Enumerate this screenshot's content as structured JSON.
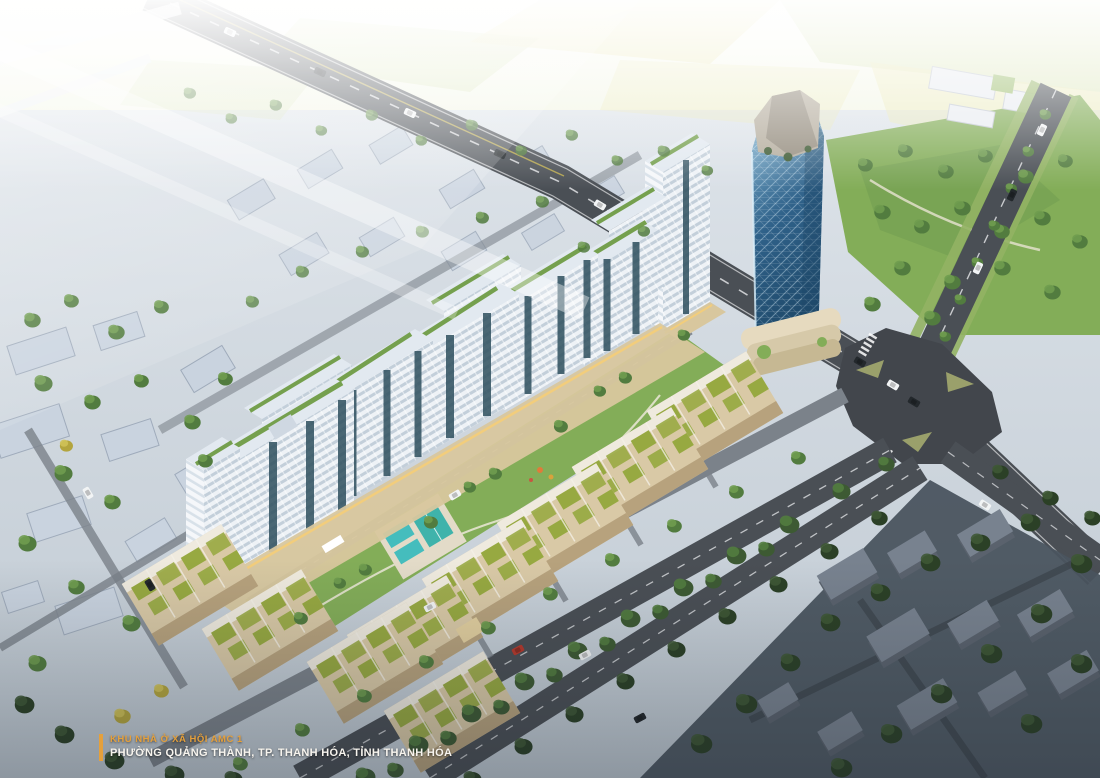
{
  "caption": {
    "project_name": "KHU NHÀ Ở XÃ HỘI AMC 1",
    "location": "PHƯỜNG QUẢNG THÀNH, TP. THANH HÓA, TỈNH THANH HÓA"
  },
  "colors": {
    "haze": "#fdfdf8",
    "fieldYellow": "#e9e6ae",
    "fieldGreen": "#d2dfaa",
    "groundLight": "#dde3e9",
    "groundMid": "#bfc9d2",
    "contextBlock": "#c9d3df",
    "contextSide": "#9fabbb",
    "campus": "#e9ecf1",
    "road": "#4a4f55",
    "roadDark": "#42464c",
    "roadLight": "#7b828a",
    "laneLine": "#e8eaec",
    "laneYellow": "#d8c24a",
    "parkGreen": "#83ad58",
    "grass": "#93b364",
    "treeDark": "#3d5a33",
    "treeMid": "#527c3f",
    "treeLight": "#6f9c4f",
    "treeDeep": "#2b4026",
    "treeDeepHi": "#3e5835",
    "treeYellow": "#b3a53e",
    "treeYellowHi": "#cfc258",
    "poolAqua": "#45bdbd",
    "courtTeal": "#3fb3ab",
    "townWall": "#d9c9a6",
    "townWallShade": "#b39d79",
    "townRoofDeck": "#efeade",
    "roofGarden": "#97a941",
    "towerWhite": "#eef2f6",
    "towerBand": "#c3cfda",
    "towerWhiteL": "#f5f7fa",
    "towerBandL": "#d8e1e9",
    "towerGlass": "#2e4f5e",
    "towerRoof": "#e2e9f0",
    "roofGreen": "#75a04e",
    "podium": "#d8c79e",
    "podiumGlow": "#f2cd7c",
    "landmark1": "#8cc0dd",
    "landmark2": "#2f6189",
    "landmarkDeep": "#1f4a6b",
    "rock": "#b5ad9e",
    "rockShade": "#8e8678",
    "darkZone": "#4a545f",
    "darkBuilding": "#78828f",
    "darkBuildingSide": "#5a626d",
    "carWhite": "#f2f4f5",
    "carDark": "#23282c",
    "carRed": "#b5392c",
    "captionOrange": "#e5a03c",
    "captionWhite": "#f7f4ee"
  }
}
